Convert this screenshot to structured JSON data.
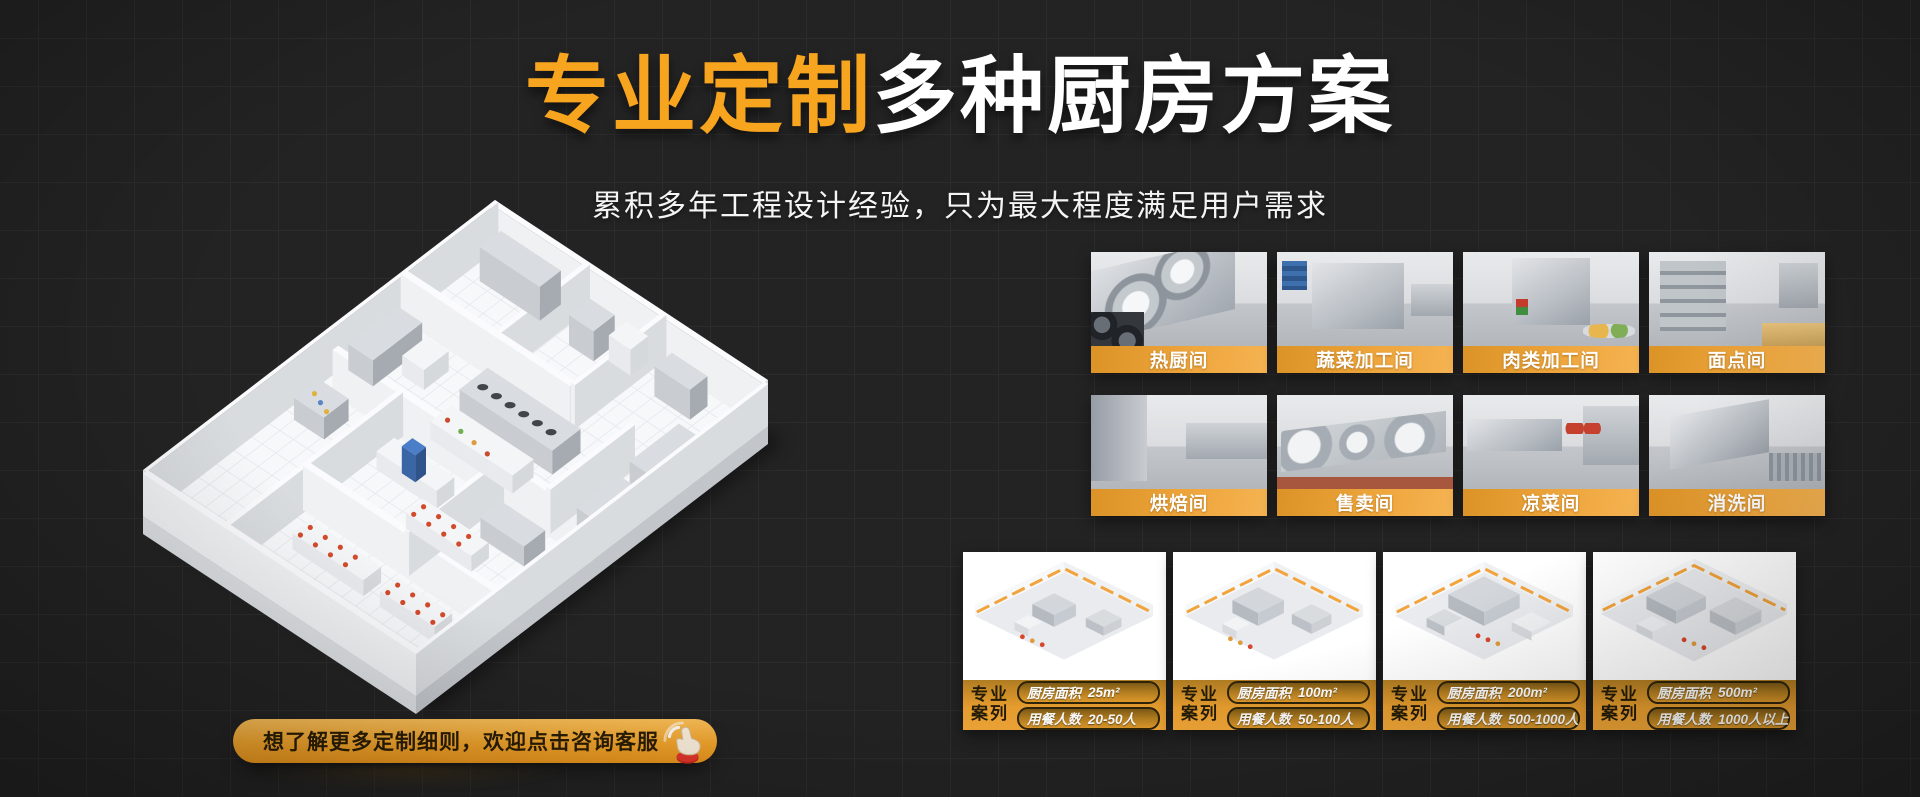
{
  "colors": {
    "background": "#232323",
    "accent_orange": "#F7A41F",
    "bar_gradient_from": "#DB9226",
    "bar_gradient_to": "#F5B352"
  },
  "hero": {
    "title_highlight": "专业定制",
    "title_rest": "多种厨房方案",
    "subtitle": "累积多年工程设计经验，只为最大程度满足用户需求"
  },
  "cta": {
    "label": "想了解更多定制细则，欢迎点击咨询客服",
    "icon": "hand-click-icon"
  },
  "floorplan": {
    "description": "isometric-3d-kitchen-floorplan-illustration"
  },
  "rooms": [
    {
      "label": "热厨间"
    },
    {
      "label": "蔬菜加工间"
    },
    {
      "label": "肉类加工间"
    },
    {
      "label": "面点间"
    },
    {
      "label": "烘焙间"
    },
    {
      "label": "售卖间"
    },
    {
      "label": "凉菜间"
    },
    {
      "label": "消洗间"
    }
  ],
  "cases": {
    "badge_line1": "专业",
    "badge_line2": "案列",
    "area_label": "厨房面积",
    "diners_label": "用餐人数",
    "items": [
      {
        "area": "25m²",
        "diners": "20-50人"
      },
      {
        "area": "100m²",
        "diners": "50-100人"
      },
      {
        "area": "200m²",
        "diners": "500-1000人"
      },
      {
        "area": "500m²",
        "diners": "1000人以上"
      }
    ]
  }
}
